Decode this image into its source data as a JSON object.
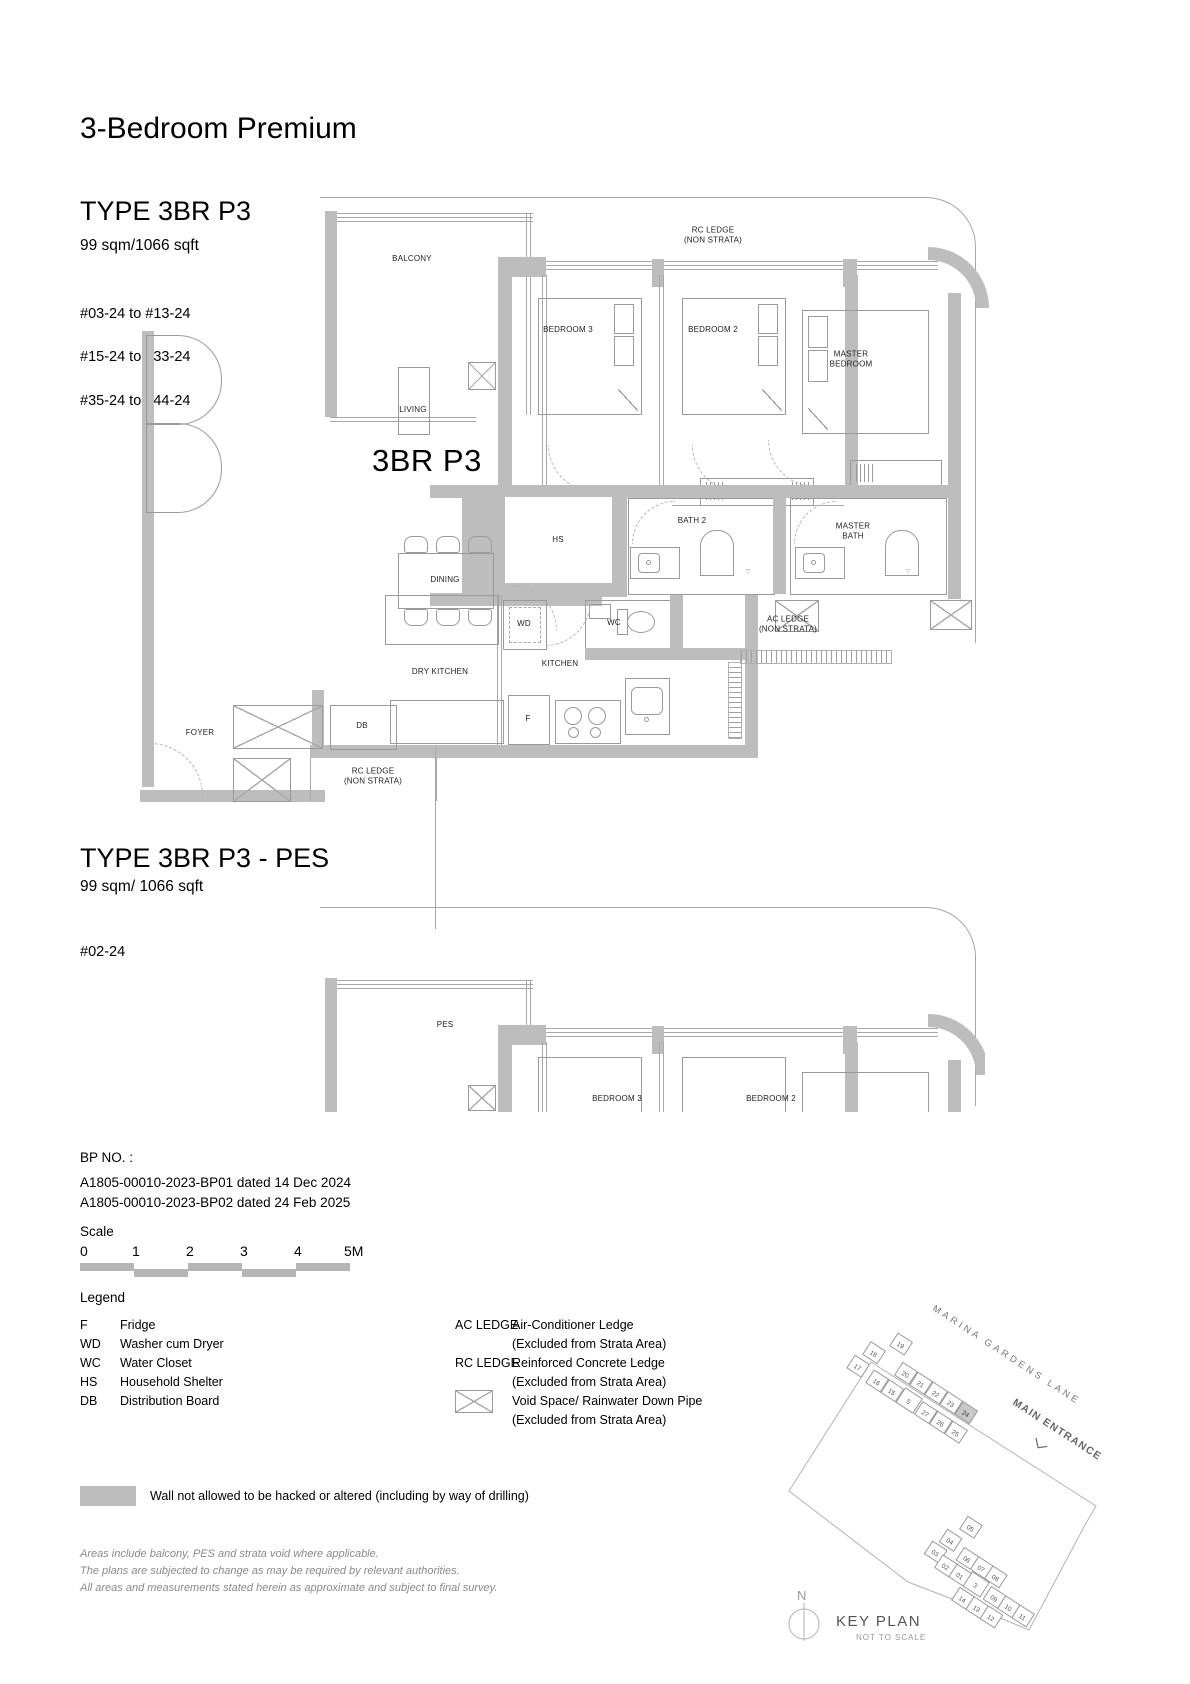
{
  "page": {
    "title": "3-Bedroom Premium"
  },
  "type1": {
    "heading": "TYPE 3BR P3",
    "area": "99 sqm/1066 sqft",
    "units": [
      "#03-24 to #13-24",
      "#15-24 to #33-24",
      "#35-24 to #44-24"
    ]
  },
  "plan1": {
    "big_label": "3BR P3",
    "rooms": {
      "balcony": "BALCONY",
      "rc_ledge_top": "RC LEDGE\n(NON STRATA)",
      "bedroom3": "BEDROOM 3",
      "bedroom2": "BEDROOM 2",
      "master_bedroom": "MASTER\nBEDROOM",
      "living": "LIVING",
      "dining": "DINING",
      "hs": "HS",
      "bath2": "BATH 2",
      "master_bath": "MASTER\nBATH",
      "wd": "WD",
      "wc": "WC",
      "ac_ledge": "AC LEDGE\n(NON STRATA)",
      "dry_kitchen": "DRY KITCHEN",
      "kitchen": "KITCHEN",
      "fridge": "F",
      "db": "DB",
      "foyer": "FOYER",
      "rc_ledge_bottom": "RC LEDGE\n(NON STRATA)"
    }
  },
  "type2": {
    "heading": "TYPE 3BR P3 - PES",
    "area": "99 sqm/ 1066 sqft",
    "units": [
      "#02-24"
    ]
  },
  "plan2": {
    "rooms": {
      "pes": "PES",
      "bedroom3": "BEDROOM 3",
      "bedroom2": "BEDROOM 2"
    }
  },
  "bp": {
    "label": "BP NO. :",
    "lines": [
      "A1805-00010-2023-BP01 dated 14 Dec 2024",
      "A1805-00010-2023-BP02 dated 24 Feb 2025"
    ]
  },
  "scale": {
    "label": "Scale",
    "ticks": [
      "0",
      "1",
      "2",
      "3",
      "4",
      "5M"
    ]
  },
  "legend": {
    "label": "Legend",
    "left": [
      {
        "abbr": "F",
        "desc": "Fridge"
      },
      {
        "abbr": "WD",
        "desc": "Washer cum Dryer"
      },
      {
        "abbr": "WC",
        "desc": "Water Closet"
      },
      {
        "abbr": "HS",
        "desc": "Household Shelter"
      },
      {
        "abbr": "DB",
        "desc": "Distribution Board"
      }
    ],
    "right": [
      {
        "abbr": "AC LEDGE",
        "desc": "Air-Conditioner Ledge",
        "note": "(Excluded from Strata Area)"
      },
      {
        "abbr": "RC LEDGE",
        "desc": "Reinforced Concrete Ledge",
        "note": "(Excluded from Strata Area)"
      },
      {
        "abbr": "",
        "desc": "Void Space/ Rainwater Down Pipe",
        "note": "(Excluded from Strata Area)"
      }
    ]
  },
  "wall_note": "Wall not allowed to be hacked or altered (including by way of drilling)",
  "disclaimer": [
    "Areas include balcony, PES and strata void where applicable.",
    "The plans are subjected to change as may be required by relevant authorities.",
    "All areas and measurements stated herein as approximate and subject to final survey."
  ],
  "keyplan": {
    "street": "MARINA GARDENS LANE",
    "entrance": "MAIN ENTRANCE",
    "north": "N",
    "title": "KEY PLAN",
    "subtitle": "NOT TO SCALE",
    "highlighted_unit": "24",
    "upper_units": [
      "19",
      "18",
      "17",
      "20",
      "21",
      "22",
      "23",
      "24",
      "16",
      "15",
      "5",
      "27",
      "26",
      "25"
    ],
    "lower_units": [
      "05",
      "04",
      "03",
      "06",
      "07",
      "08",
      "02",
      "01",
      "3",
      "09",
      "10",
      "11",
      "14",
      "13",
      "12"
    ]
  },
  "colors": {
    "wall": "#bdbdbd",
    "unit_highlight": "#c9c9c9",
    "line": "#a8a8a8"
  }
}
